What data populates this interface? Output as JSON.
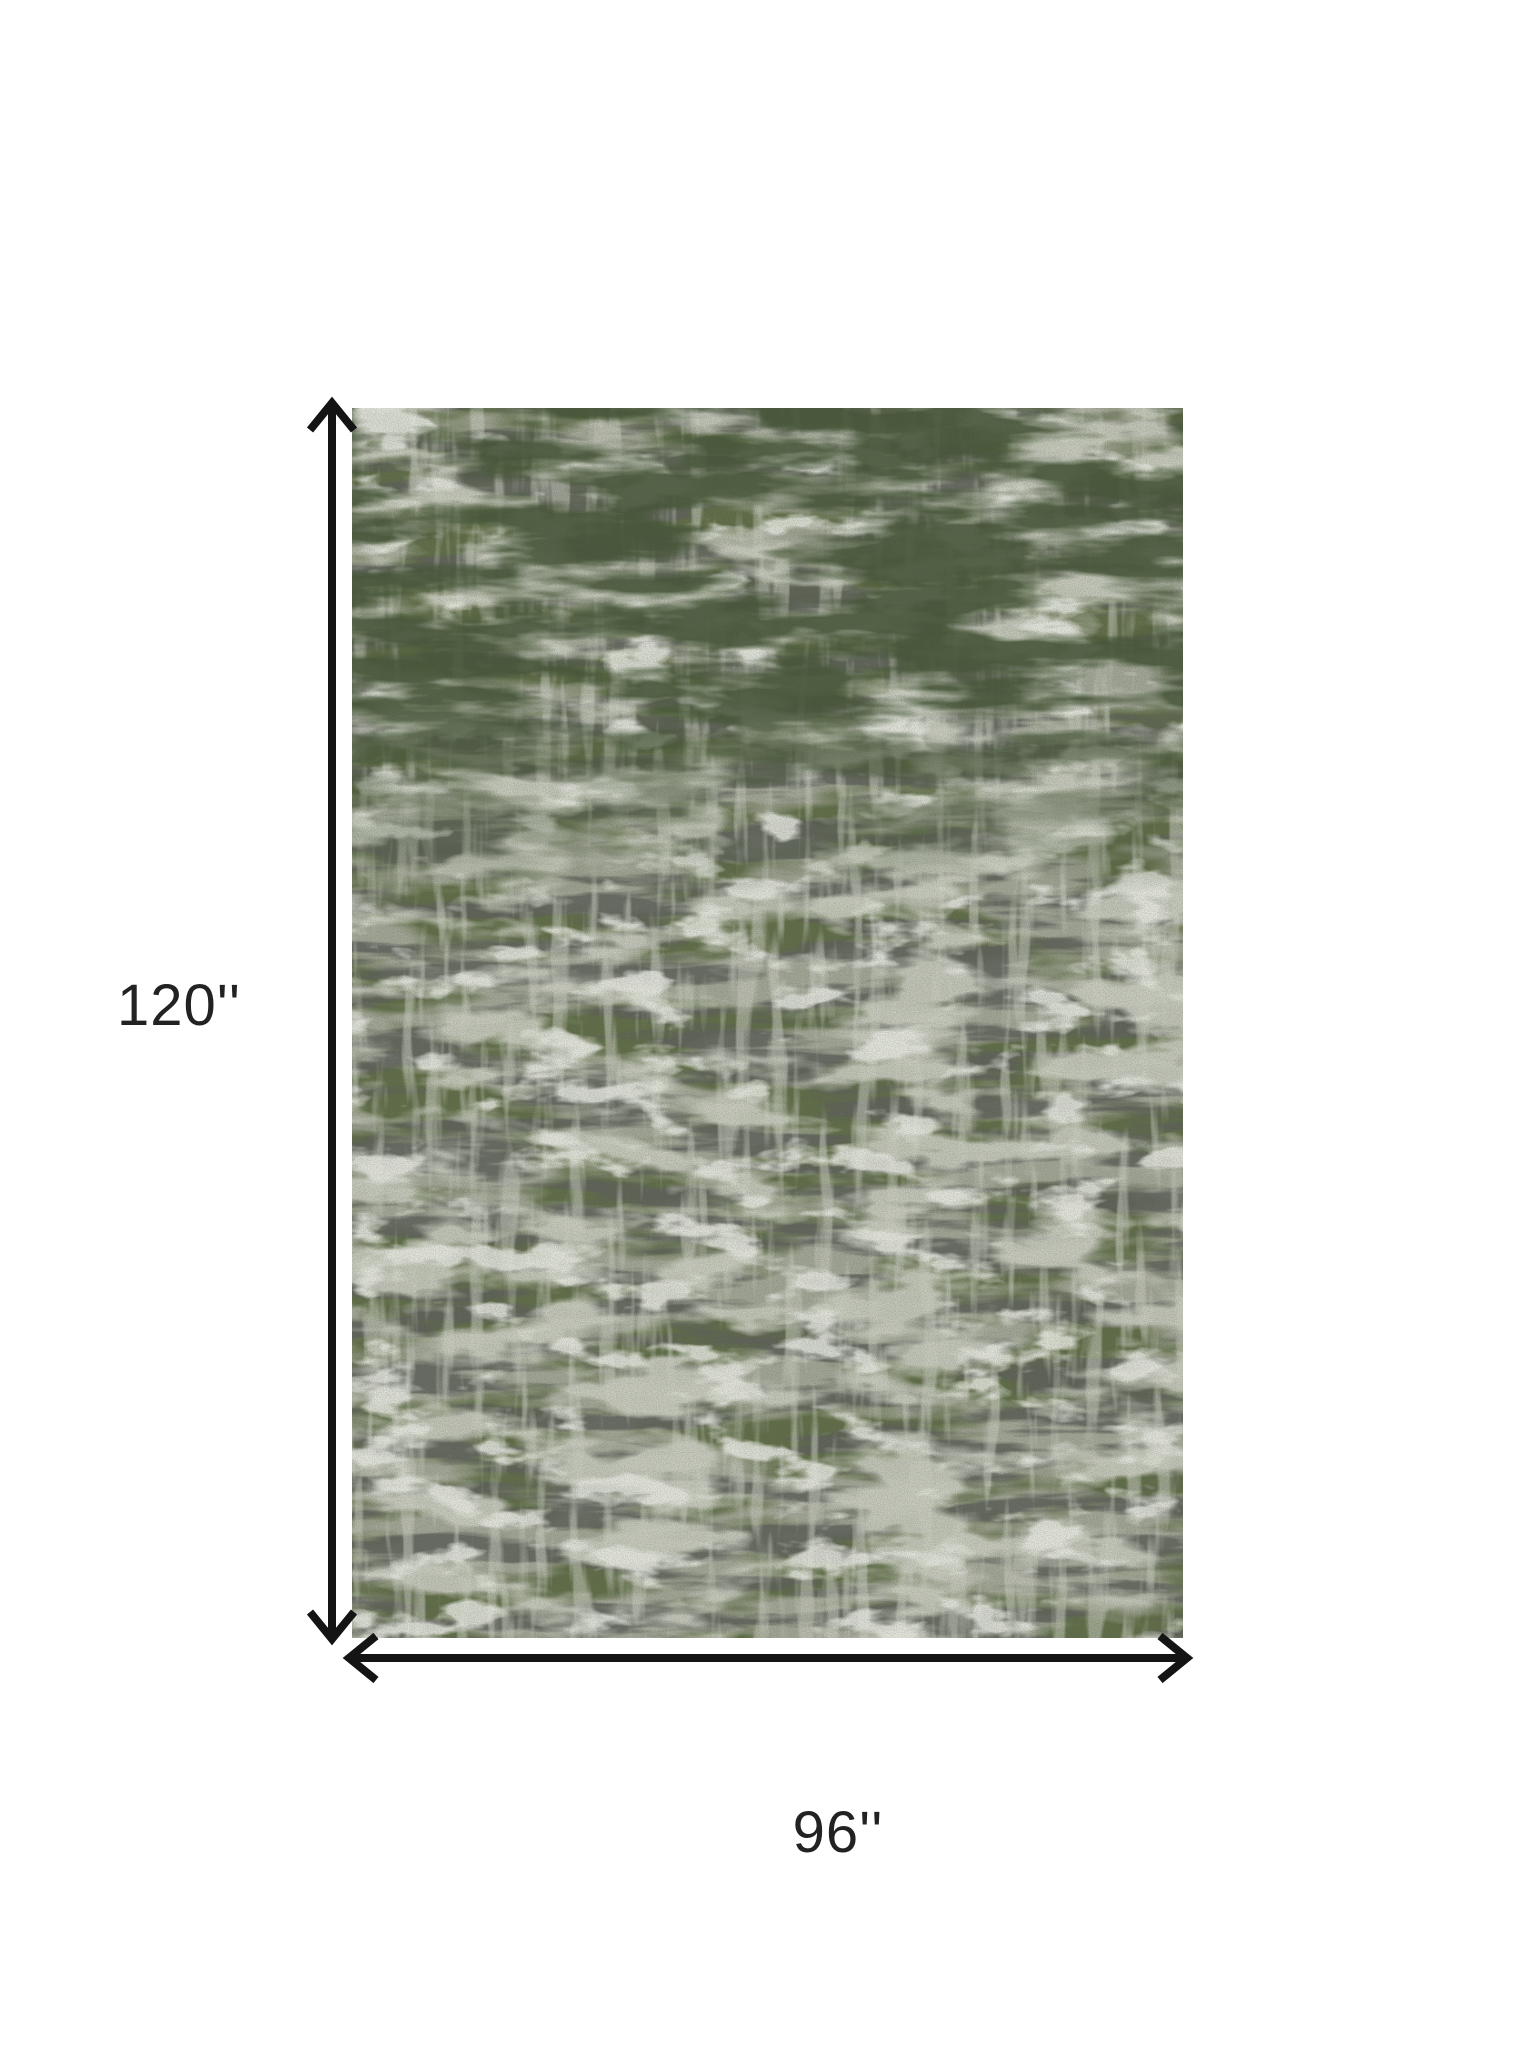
{
  "page": {
    "background": "#ffffff"
  },
  "dimension_diagram": {
    "height_label": "120''",
    "width_label": "96''",
    "arrow_color": "#141414",
    "label_color": "#222222"
  },
  "rug": {
    "kind": "distressed-abstract-rug-swatch",
    "colors": {
      "base": "#a3a797",
      "olive_green": "#5c6b42",
      "deep_green": "#49593a",
      "dark_gray": "#60635c",
      "light_gray": "#cdd0c3",
      "white_patch": "#eaece4",
      "grain_dark": "#3d4138"
    }
  }
}
